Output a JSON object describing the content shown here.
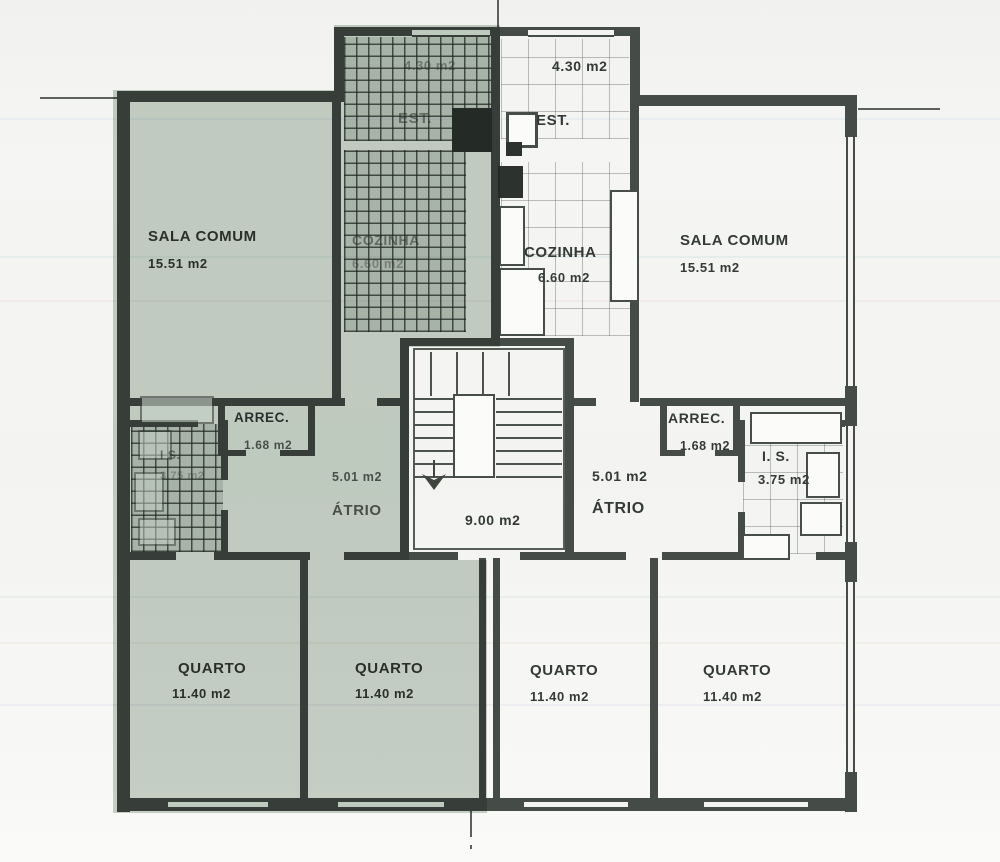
{
  "plan": {
    "title": "apartment-floor-plan",
    "stairwell": {
      "area": "9.00 m2"
    },
    "rooms": {
      "sala_left": {
        "name": "SALA COMUM",
        "area": "15.51 m2"
      },
      "cozinha_left": {
        "name": "COZINHA",
        "area": "6.60 m2"
      },
      "est_left": {
        "name": "EST.",
        "area": "4.30 m2"
      },
      "arrec_left": {
        "name": "ARREC.",
        "area": "1.68 m2"
      },
      "is_left": {
        "name": "I S.",
        "area": "3.75 m2"
      },
      "atrio_left": {
        "name": "ÁTRIO",
        "area": "5.01 m2"
      },
      "quarto_left_1": {
        "name": "QUARTO",
        "area": "11.40 m2"
      },
      "quarto_left_2": {
        "name": "QUARTO",
        "area": "11.40 m2"
      },
      "est_right": {
        "name": "EST.",
        "area": "4.30 m2"
      },
      "cozinha_right": {
        "name": "COZINHA",
        "area": "6.60 m2"
      },
      "sala_right": {
        "name": "SALA COMUM",
        "area": "15.51 m2"
      },
      "arrec_right": {
        "name": "ARREC.",
        "area": "1.68 m2"
      },
      "is_right": {
        "name": "I. S.",
        "area": "3.75 m2"
      },
      "atrio_right": {
        "name": "ÁTRIO",
        "area": "5.01 m2"
      },
      "quarto_right_1": {
        "name": "QUARTO",
        "area": "11.40 m2"
      },
      "quarto_right_2": {
        "name": "QUARTO",
        "area": "11.40 m2"
      }
    },
    "colors": {
      "highlight_tint": "#9cae9f",
      "wall": "#454b47",
      "paper": "#f5f5f3"
    }
  }
}
